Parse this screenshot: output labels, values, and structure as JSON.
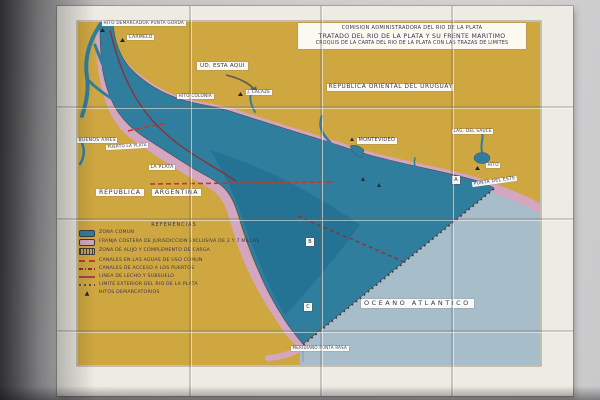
{
  "colors": {
    "wall": "#c7c7c8",
    "tile": "#ece9e2",
    "land": "#cfa741",
    "river": "#2f7e9e",
    "river_deep": "#1c6a8d",
    "ocean": "#a7bdca",
    "fringe": "#d4a6c0",
    "ink": "#3a3450",
    "red_line": "#bf3a2b",
    "maroon": "#8c2f3a",
    "dots": "#3c3c44"
  },
  "title_block": {
    "line1": "COMISION ADMINISTRADORA DEL RIO DE LA PLATA",
    "line2": "TRATADO DEL RIO DE LA PLATA Y SU FRENTE MARITIMO",
    "line3": "CROQUIS DE LA CARTA DEL RIO DE LA PLATA CON LAS TRAZAS DE LIMITES"
  },
  "labels": {
    "punta_gorda": "HITO DEMARCADOR PUNTA GORDA",
    "carmelo": "CARMELO",
    "ud_esta_aqui": "UD. ESTA AQUI",
    "hito_colonia": "HITO COLONIA",
    "j_lacaze": "J. LACAZE",
    "uruguay": "REPUBLICA ORIENTAL DEL URUGUAY",
    "montevideo": "MONTEVIDEO",
    "lag_del_sauce": "LAG. DEL SAUCE",
    "hito": "HITO",
    "punta_del_este": "PUNTA DEL ESTE",
    "buenos_aires": "BUENOS AIRES",
    "puerto_la_plata": "PUERTO LA PLATA",
    "la_plata": "LA PLATA",
    "republica": "REPUBLICA",
    "argentina": "ARGENTINA",
    "oceano_atlantico": "OCEANO ATLANTICO",
    "meridiano_punta_rasa": "MERIDIANO PUNTA RASA",
    "marker_a": "A",
    "marker_b": "B",
    "marker_c": "C"
  },
  "legend": {
    "title": "REFERENCIAS",
    "items": [
      {
        "symbol": "zona-comun-swatch",
        "label": "ZONA COMUN"
      },
      {
        "symbol": "franja-costera-swatch",
        "label": "FRANJA COSTERA DE JURISDICCION EXCLUSIVA DE 2 Y 7 MILLAS"
      },
      {
        "symbol": "zona-alijo-swatch",
        "label": "ZONA DE ALIJO Y COMPLEMENTO DE CARGA"
      },
      {
        "symbol": "canales-uso-comun-line",
        "label": "CANALES EN LAS AGUAS DE USO COMUN"
      },
      {
        "symbol": "canales-acceso-line",
        "label": "CANALES DE ACCESO A LOS PUERTOS"
      },
      {
        "symbol": "lecho-subsuelo-line",
        "label": "LINEA DE LECHO Y SUBSUELO"
      },
      {
        "symbol": "limite-exterior-line",
        "label": "LIMITE EXTERIOR DEL RIO DE LA PLATA"
      },
      {
        "symbol": "hitos-triangle",
        "label": "HITOS DEMARCATORIOS"
      }
    ]
  }
}
